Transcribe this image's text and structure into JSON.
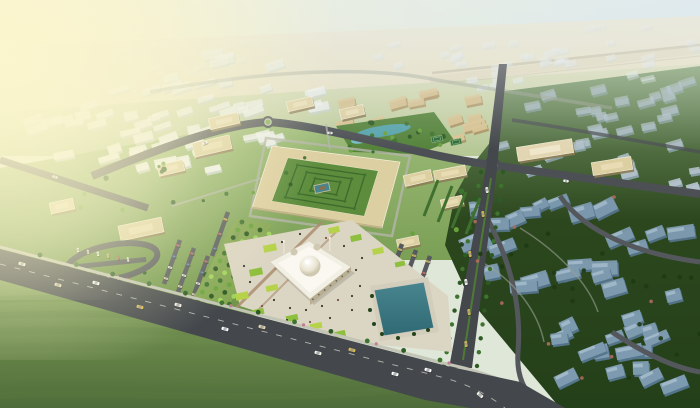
{
  "scene_type": "aerial-3d-city-masterplan-render",
  "canvas": {
    "width": 700,
    "height": 408
  },
  "palette": {
    "sky_left": "#f3edc6",
    "sky_right": "#cfe3ef",
    "horizon_haze": "#e7e0c6",
    "far_ground_top": "#e0e0c0",
    "far_ground_bot": "#b4c794",
    "campus_ground_top": "#9cbb77",
    "campus_ground_bot": "#6d9347",
    "right_ground_top": "#7b9a6b",
    "right_ground_mid": "#2c471d",
    "right_ground_bot": "#24401a",
    "field_top": "#8fae63",
    "field_bot": "#4e6c39",
    "field_stripe": "#5f7f45",
    "road_dark": "#44484c",
    "road_mid": "#4c5054",
    "road_far": "#9aa091",
    "sidewalk": "#c3c5b6",
    "lane_dash": "#d8d8cf",
    "white_top": "#eef1ee",
    "white_side": "#c6d1ce",
    "tan_top": "#d8c494",
    "tan_side": "#ab9162",
    "blue_hi_top": "#b6c4cd",
    "blue_hi_side": "#93a9b6",
    "blue_lo_top": "#7e9bb0",
    "blue_lo_side": "#55758c",
    "blue_lo_edge": "#a9c0cf",
    "quad_wall": "#dccfa2",
    "quad_shade": "#b3a478",
    "quad_edge": "#f5f0dc",
    "courtyard": "#5c8c3c",
    "hedge": "#3c6a2c",
    "tree_dark": "#2e5a24",
    "tree_mid": "#3f7330",
    "tree_light": "#69a23c",
    "tree_bright": "#9fd45e",
    "tree_blue_district": "#1e3a14",
    "flower": "#b06a5f",
    "shrub_pink": "#c27f92",
    "pond": "#57a3ab",
    "pond_light": "#74bcc2",
    "pool_top": "#49858e",
    "pool_bot": "#2f6a74",
    "pool_deck": "#d3cdbc",
    "plaza": "#dbd5c3",
    "plaza_strip": "#ab8a6e",
    "lawn_a": "#b6d24a",
    "lawn_b": "#8fbf3e",
    "mosque_white": "#f2efe5",
    "mosque_light": "#faf8f0",
    "mosque_shade": "#b7ae93",
    "mosque_arch": "#6b6453",
    "dome_hi": "#ffffff",
    "dome_lo": "#cfc9b2",
    "people": "#3c3a34",
    "people_warm": "#7a5348",
    "glow": "#fcf6cd",
    "haze": "#ebefed",
    "car_body": [
      "#f2efe6",
      "#e0d6ae",
      "#ffffff",
      "#d9ba4e",
      "#b2564c",
      "#4a6f94",
      "#ccc8bd"
    ]
  },
  "sky": {
    "horizon_poly": [
      [
        0,
        46
      ],
      [
        700,
        16
      ],
      [
        700,
        64
      ],
      [
        0,
        112
      ]
    ],
    "highway_band": {
      "d": "M430,80 L700,50",
      "w": 8,
      "op": 0.3
    },
    "highway_lines": [
      {
        "d": "M432,73 L700,45",
        "w": 2.6,
        "op": 0.6
      },
      {
        "d": "M448,83 L700,56",
        "w": 1.2,
        "op": 0.35
      }
    ]
  },
  "grounds": {
    "campus_poly": [
      [
        0,
        168
      ],
      [
        270,
        120
      ],
      [
        490,
        166
      ],
      [
        478,
        260
      ],
      [
        300,
        260
      ],
      [
        250,
        320
      ],
      [
        0,
        300
      ]
    ],
    "right_poly": [
      [
        498,
        92
      ],
      [
        700,
        66
      ],
      [
        700,
        408
      ],
      [
        560,
        408
      ],
      [
        520,
        360
      ],
      [
        470,
        300
      ],
      [
        445,
        245
      ],
      [
        455,
        195
      ],
      [
        470,
        168
      ],
      [
        492,
        140
      ]
    ],
    "field_poly": [
      [
        0,
        252
      ],
      [
        448,
        368
      ],
      [
        520,
        382
      ],
      [
        470,
        408
      ],
      [
        0,
        408
      ]
    ],
    "field_stripes_y": [
      300,
      316,
      332,
      348,
      364,
      380,
      396
    ],
    "park_poly": [
      [
        336,
        126
      ],
      [
        434,
        112
      ],
      [
        454,
        140
      ],
      [
        418,
        154
      ],
      [
        352,
        152
      ]
    ]
  },
  "districts": [
    {
      "name": "distant-city-band",
      "seed": 11,
      "count": 40,
      "poly": [
        [
          350,
          46
        ],
        [
          700,
          16
        ],
        [
          700,
          88
        ],
        [
          430,
          92
        ]
      ],
      "block": {
        "wmin": 8,
        "wmax": 14,
        "hmin": 4,
        "hmax": 6,
        "rot": -15,
        "jit": 8,
        "top": "#e9eef0",
        "side": "#cdd8da",
        "opmin": 0.22,
        "opmax": 0.5
      }
    },
    {
      "name": "distant-city-left",
      "seed": 12,
      "count": 16,
      "poly": [
        [
          40,
          36
        ],
        [
          210,
          16
        ],
        [
          330,
          40
        ],
        [
          160,
          84
        ]
      ],
      "block": {
        "wmin": 7,
        "wmax": 12,
        "hmin": 3,
        "hmax": 5,
        "rot": -16,
        "jit": 6,
        "top": "#eef0e8",
        "side": "#d6dcd2",
        "opmin": 0.15,
        "opmax": 0.32
      }
    },
    {
      "name": "white-district",
      "seed": 22,
      "count": 64,
      "poly": [
        [
          24,
          108
        ],
        [
          205,
          52
        ],
        [
          348,
          78
        ],
        [
          338,
          112
        ],
        [
          196,
          180
        ],
        [
          36,
          150
        ]
      ],
      "block": {
        "wmin": 10,
        "wmax": 23,
        "hmin": 5,
        "hmax": 9,
        "rot": -16,
        "jit": 10,
        "top": "#eef1ee",
        "side": "#c6d1ce",
        "opmin": 0.5,
        "opmax": 1.0
      }
    },
    {
      "name": "tan-district",
      "seed": 33,
      "count": 26,
      "poly": [
        [
          333,
          122
        ],
        [
          352,
          86
        ],
        [
          500,
          94
        ],
        [
          488,
          136
        ],
        [
          430,
          146
        ],
        [
          380,
          140
        ]
      ],
      "block": {
        "wmin": 10,
        "wmax": 19,
        "hmin": 6,
        "hmax": 9,
        "rot": -14,
        "jit": 7,
        "top": "#d8c494",
        "side": "#ab9162",
        "opmin": 0.8,
        "opmax": 1.0
      }
    },
    {
      "name": "right-district-upper",
      "seed": 44,
      "count": 34,
      "poly": [
        [
          505,
          100
        ],
        [
          700,
          72
        ],
        [
          700,
          190
        ],
        [
          560,
          185
        ],
        [
          492,
          150
        ],
        [
          498,
          118
        ]
      ],
      "block": {
        "wmin": 10,
        "wmax": 18,
        "hmin": 6,
        "hmax": 9,
        "rot": -14,
        "jit": 9,
        "top": "#b6c4cd",
        "side": "#93a9b6",
        "opmin": 0.45,
        "opmax": 0.95
      }
    },
    {
      "name": "right-district-lower",
      "seed": 55,
      "count": 42,
      "poly": [
        [
          462,
          205
        ],
        [
          555,
          195
        ],
        [
          700,
          198
        ],
        [
          700,
          404
        ],
        [
          585,
          404
        ],
        [
          540,
          352
        ],
        [
          492,
          300
        ],
        [
          458,
          248
        ]
      ],
      "block": {
        "wmin": 14,
        "wmax": 28,
        "hmin": 9,
        "hmax": 15,
        "rot": -14,
        "jit": 26,
        "top": "#7e9bb0",
        "side": "#55758c",
        "opmin": 0.92,
        "opmax": 1.0,
        "edge": "#a9c0cf"
      }
    }
  ],
  "roads": {
    "boulevard_poly": [
      [
        0,
        249
      ],
      [
        447,
        366
      ],
      [
        520,
        382
      ],
      [
        565,
        408
      ],
      [
        470,
        408
      ],
      [
        425,
        400
      ],
      [
        0,
        280
      ]
    ],
    "boulevard_dash": "M0,264 L445,378 Q480,388 505,408",
    "boulevard_sidewalk": "M0,247 L447,364 Q505,376 548,404",
    "avenue_poly": [
      [
        449,
        368
      ],
      [
        472,
        368
      ],
      [
        497,
        168
      ],
      [
        507,
        64
      ],
      [
        499,
        64
      ],
      [
        486,
        168
      ]
    ],
    "avenue_median": "M463,360 L491,178",
    "street_main": "M92,176 C180,140 230,124 268,122 C330,126 420,156 492,165 C540,172 640,186 700,194",
    "street_left": "M0,160 L148,208",
    "street_top": "M150,92 C300,64 390,70 436,80 C500,90 560,100 612,108",
    "street_upper_right": "M512,120 C580,130 644,142 700,152",
    "right_internal": [
      "M480,206 C508,252 522,300 518,352 C516,380 526,394 544,408",
      "M560,196 C586,234 640,254 700,262",
      "M612,332 C648,356 676,368 700,372"
    ],
    "right_walkways": [
      "M520,228 C556,250 588,282 598,312",
      "M482,262 C516,282 538,312 544,342"
    ],
    "service_loop": "M250,216 L266,138 L410,156 L392,236 Z",
    "service_spurs": [
      "M330,150 L326,124",
      "M318,236 L308,262",
      "M262,178 L172,206"
    ]
  },
  "roundabouts": [
    {
      "x": 268,
      "y": 122,
      "r": 6,
      "core": 2.6
    },
    {
      "x": 492,
      "y": 165,
      "r": 8.5,
      "core": 4.2
    }
  ],
  "campus": {
    "quad_outer": [
      [
        272,
        146
      ],
      [
        400,
        162
      ],
      [
        382,
        228
      ],
      [
        252,
        208
      ]
    ],
    "quad_inner": [
      [
        288,
        158
      ],
      [
        378,
        171
      ],
      [
        364,
        216
      ],
      [
        272,
        201
      ]
    ],
    "hedge_scales": [
      0.75,
      0.5,
      0.28
    ],
    "center_feature": {
      "x": 322,
      "y": 188,
      "w": 15,
      "h": 8,
      "rot": -12
    },
    "satellites": [
      [
        212,
        146,
        38,
        14,
        -13,
        0
      ],
      [
        224,
        121,
        30,
        11,
        -13,
        0
      ],
      [
        171,
        168,
        26,
        11,
        -13,
        0
      ],
      [
        141,
        229,
        44,
        15,
        -12,
        0
      ],
      [
        300,
        104,
        26,
        10,
        -13,
        0
      ],
      [
        352,
        112,
        24,
        10,
        -13,
        0
      ],
      [
        418,
        178,
        28,
        11,
        -13,
        0
      ],
      [
        452,
        202,
        22,
        9,
        -13,
        0
      ],
      [
        345,
        247,
        28,
        10,
        -13,
        0
      ],
      [
        408,
        242,
        22,
        9,
        -12,
        0
      ],
      [
        545,
        150,
        56,
        14,
        -9,
        1
      ],
      [
        612,
        166,
        40,
        13,
        -9,
        0
      ],
      [
        450,
        173,
        32,
        10,
        -11,
        0
      ],
      [
        62,
        206,
        24,
        11,
        -12,
        0
      ]
    ],
    "tennis": [
      [
        437,
        139
      ],
      [
        456,
        142
      ]
    ],
    "pond": {
      "cx": 383,
      "cy": 131,
      "rx": 28,
      "ry": 5.5,
      "rot": -9,
      "blob": [
        360,
        140,
        9,
        3.5
      ]
    },
    "hedge_rows_east": [
      [
        438,
        180,
        424,
        216
      ],
      [
        452,
        186,
        438,
        222
      ],
      [
        466,
        192,
        452,
        228
      ],
      [
        480,
        198,
        466,
        234
      ]
    ]
  },
  "parking": {
    "loop": {
      "cx": 112,
      "cy": 262,
      "rx": 46,
      "ry": 17,
      "rot": -11
    },
    "loop_car_rows": [
      {
        "x": 78,
        "y": 250,
        "dx": 10,
        "dy": 1.9,
        "n": 6,
        "rot": 79
      },
      {
        "x": 88,
        "y": 272,
        "dx": 10,
        "dy": 1.9,
        "n": 5,
        "rot": 79
      }
    ],
    "strips": [
      [
        180,
        240,
        164,
        284,
        4
      ],
      [
        194,
        248,
        178,
        292,
        4
      ],
      [
        208,
        256,
        192,
        300,
        4
      ],
      [
        228,
        212,
        212,
        256,
        3
      ],
      [
        242,
        220,
        226,
        264,
        3
      ],
      [
        402,
        244,
        390,
        278,
        3
      ],
      [
        416,
        250,
        404,
        284,
        3
      ],
      [
        430,
        256,
        418,
        290,
        3
      ]
    ]
  },
  "mall": {
    "band_poly": [
      [
        192,
        300
      ],
      [
        236,
        218
      ],
      [
        272,
        224
      ],
      [
        228,
        308
      ]
    ],
    "rows": [
      [
        242,
        222,
        198,
        300
      ],
      [
        251,
        226,
        207,
        304
      ],
      [
        260,
        230,
        216,
        308
      ],
      [
        269,
        234,
        225,
        312
      ]
    ],
    "trees_per_row": 11
  },
  "plaza": {
    "poly": [
      [
        224,
        244
      ],
      [
        352,
        220
      ],
      [
        448,
        296
      ],
      [
        452,
        352
      ],
      [
        350,
        342
      ],
      [
        240,
        306
      ]
    ],
    "lawn_patches": [
      [
        242,
        296,
        13,
        7,
        0
      ],
      [
        256,
        272,
        13,
        7,
        1
      ],
      [
        270,
        248,
        13,
        7,
        0
      ],
      [
        258,
        312,
        12,
        6,
        1
      ],
      [
        272,
        288,
        12,
        6,
        0
      ],
      [
        334,
        230,
        11,
        6,
        0
      ],
      [
        356,
        238,
        11,
        6,
        1
      ],
      [
        378,
        251,
        11,
        6,
        0
      ],
      [
        400,
        264,
        10,
        5,
        1
      ],
      [
        292,
        318,
        12,
        6,
        1
      ],
      [
        316,
        326,
        12,
        6,
        0
      ],
      [
        340,
        334,
        11,
        6,
        1
      ]
    ],
    "brown_strips": [
      [
        236,
        308,
        322,
        222
      ],
      [
        250,
        318,
        336,
        232
      ]
    ],
    "people": [
      [
        262,
        306
      ],
      [
        274,
        300
      ],
      [
        290,
        308
      ],
      [
        306,
        310
      ],
      [
        322,
        306
      ],
      [
        338,
        300
      ],
      [
        352,
        296
      ],
      [
        360,
        286
      ],
      [
        352,
        310
      ],
      [
        330,
        318
      ],
      [
        310,
        322
      ],
      [
        287,
        320
      ],
      [
        356,
        270
      ],
      [
        362,
        258
      ],
      [
        344,
        246
      ],
      [
        326,
        238
      ],
      [
        300,
        234
      ],
      [
        282,
        242
      ],
      [
        250,
        282
      ],
      [
        244,
        266
      ],
      [
        296,
        330
      ],
      [
        318,
        334
      ]
    ]
  },
  "mosque": {
    "base": [
      [
        270,
        262
      ],
      [
        309,
        241
      ],
      [
        351,
        267
      ],
      [
        310,
        299
      ]
    ],
    "shade_face": [
      [
        310,
        299
      ],
      [
        351,
        267
      ],
      [
        351,
        272
      ],
      [
        310,
        305
      ]
    ],
    "dome": {
      "cx": 310,
      "cy": 266,
      "r": 10.5
    },
    "small_domes": [
      [
        294,
        252,
        3.5
      ],
      [
        317,
        247,
        3.5
      ]
    ],
    "minarets": [
      [
        283,
        242
      ],
      [
        329,
        239
      ]
    ],
    "arch_dots": 7
  },
  "pool": {
    "pts": [
      [
        374,
        290
      ],
      [
        424,
        282
      ],
      [
        434,
        328
      ],
      [
        384,
        336
      ]
    ],
    "deck": [
      [
        370,
        286
      ],
      [
        428,
        277
      ],
      [
        439,
        332
      ],
      [
        380,
        341
      ]
    ],
    "trees": [
      [
        372,
        296
      ],
      [
        370,
        310
      ],
      [
        374,
        324
      ],
      [
        382,
        334
      ],
      [
        398,
        338
      ],
      [
        414,
        334
      ],
      [
        428,
        330
      ]
    ]
  },
  "cars": {
    "boulevard": [
      [
        22,
        264,
        15,
        0
      ],
      [
        58,
        285,
        15,
        1
      ],
      [
        96,
        283,
        15,
        2
      ],
      [
        140,
        307,
        15,
        3
      ],
      [
        178,
        305,
        15,
        0
      ],
      [
        225,
        329,
        15,
        2
      ],
      [
        262,
        327,
        15,
        1
      ],
      [
        318,
        353,
        15,
        0
      ],
      [
        352,
        350,
        15,
        3
      ],
      [
        395,
        374,
        15,
        2
      ],
      [
        428,
        370,
        15,
        2
      ],
      [
        480,
        395,
        40,
        0
      ]
    ],
    "avenue": [
      [
        466,
        344,
        81,
        3
      ],
      [
        469,
        312,
        81,
        3
      ],
      [
        466,
        282,
        81,
        2
      ],
      [
        470,
        254,
        81,
        3
      ],
      [
        483,
        214,
        81,
        3
      ],
      [
        487,
        190,
        81,
        0
      ]
    ],
    "street": [
      [
        205,
        143,
        -21,
        2
      ],
      [
        330,
        133,
        5,
        0
      ],
      [
        566,
        181,
        7,
        2
      ],
      [
        55,
        177,
        18,
        0
      ]
    ]
  },
  "trees": {
    "avenue_lines": [
      [
        444,
        366,
        481,
        172,
        15
      ],
      [
        477,
        366,
        503,
        172,
        15
      ]
    ],
    "boulevard_line": [
      40,
      259,
      440,
      364,
      12
    ],
    "campus_scatter": {
      "seed": 66,
      "count": 26,
      "poly": [
        [
          60,
          180
        ],
        [
          270,
          126
        ],
        [
          470,
          170
        ],
        [
          460,
          240
        ],
        [
          300,
          250
        ],
        [
          250,
          300
        ],
        [
          80,
          260
        ]
      ]
    },
    "park_scatter": {
      "seed": 77,
      "count": 16
    },
    "right_scatter": {
      "seed": 88,
      "count": 22,
      "pink": 9
    }
  },
  "glow": {
    "cx": 10,
    "cy": 55,
    "r": 330,
    "cx2": 0,
    "cy2": 130,
    "r2": 210
  }
}
